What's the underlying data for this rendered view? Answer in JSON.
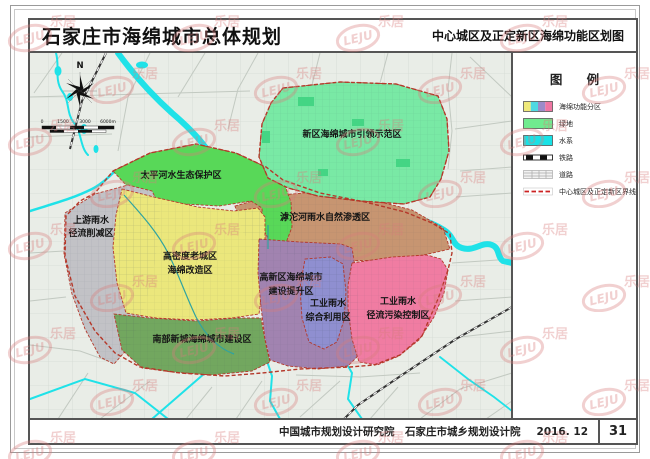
{
  "header": {
    "title": "石家庄市海绵城市总体规划",
    "subtitle": "中心城区及正定新区海绵功能区划图"
  },
  "legend": {
    "title": "图 例",
    "items": [
      {
        "label": "海绵功能分区",
        "colors": [
          "#EFE97B",
          "#4FD9E2",
          "#9C8BC9",
          "#EF76A3"
        ]
      },
      {
        "label": "绿地",
        "color": "#70EB8F"
      },
      {
        "label": "水系",
        "color": "#18E2E6"
      },
      {
        "label": "铁路"
      },
      {
        "label": "道路"
      },
      {
        "label": "中心城区及正定新区界线",
        "color": "#CC2222"
      }
    ]
  },
  "map": {
    "compass_label": "N",
    "scale": {
      "ticks": [
        "0",
        "1500",
        "3000",
        "6000m"
      ]
    },
    "colors": {
      "background": "#E9EDE7",
      "road": "#C2C9C1",
      "water": "#1FE2E8",
      "canal": "#2FA3A0",
      "railway": "#333333",
      "boundary": "#B5382A",
      "park": "#44D584"
    },
    "regions": [
      {
        "name": "新区海绵城市引领示范区",
        "color": "#79E9A5",
        "lines": [
          "新区海绵城市引领示范区"
        ]
      },
      {
        "name": "太平河水生态保护区",
        "color": "#58D858",
        "lines": [
          "太平河水生态保护区"
        ]
      },
      {
        "name": "上游雨水径流削减区",
        "color": "#C2C2C6",
        "lines": [
          "上游雨水",
          "径流削减区"
        ]
      },
      {
        "name": "高密度老城区海绵改造区",
        "color": "#EBE77C",
        "lines": [
          "高密度老城区",
          "海绵改造区"
        ]
      },
      {
        "name": "滹沱河雨水自然渗透区",
        "color": "#C79571",
        "lines": [
          "滹沱河雨水自然渗透区"
        ]
      },
      {
        "name": "高新区海绵城市建设提升区",
        "color": "#A183B0",
        "lines": [
          "高新区海绵城市",
          "建设提升区"
        ]
      },
      {
        "name": "工业雨水综合利用区",
        "color": "#8F8FD0",
        "lines": [
          "工业雨水",
          "综合利用区"
        ]
      },
      {
        "name": "工业雨水径流污染控制区",
        "color": "#F07CA2",
        "lines": [
          "工业雨水",
          "径流污染控制区"
        ]
      },
      {
        "name": "南部新城海绵城市建设区",
        "color": "#72A75F",
        "lines": [
          "南部新城海绵城市建设区"
        ]
      }
    ]
  },
  "footer": {
    "credits": "中国城市规划设计研究院　石家庄市城乡规划设计院",
    "date": "2016. 12",
    "page": "31"
  },
  "watermark": {
    "logo": "LEJU",
    "text": "乐居",
    "color": "#D97C7C"
  }
}
